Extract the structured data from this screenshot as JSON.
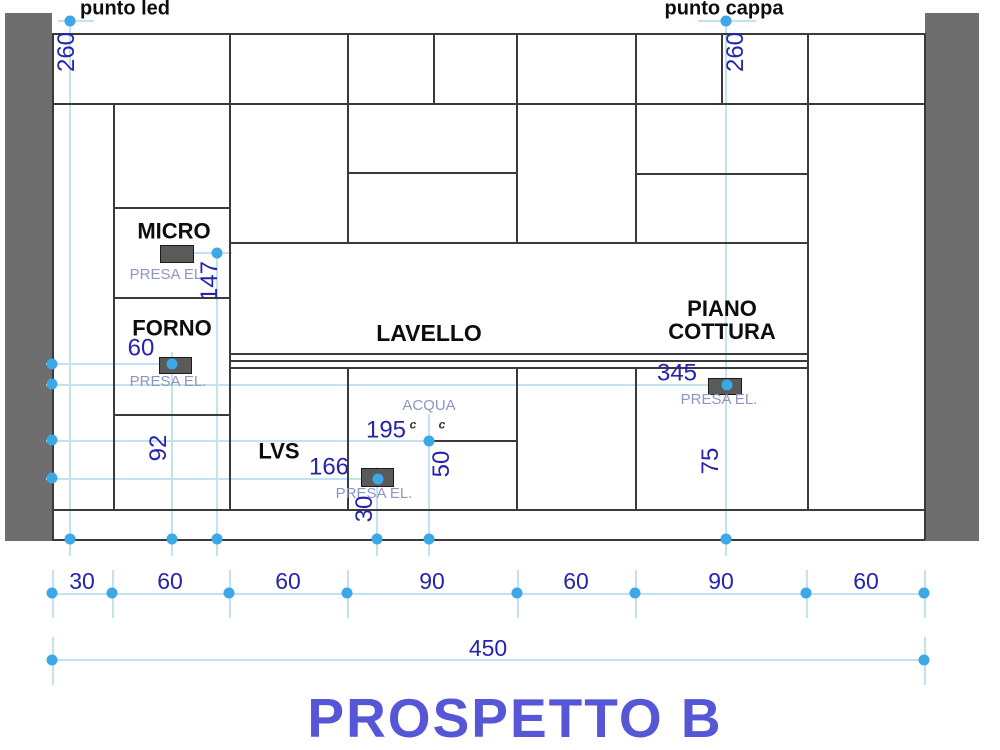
{
  "title": "PROSPETTO B",
  "points": {
    "led": {
      "label": "punto led",
      "height": "260"
    },
    "cappa": {
      "label": "punto cappa",
      "height": "260"
    }
  },
  "cabinets": {
    "micro": "MICRO",
    "forno": "FORNO",
    "lvs": "LVS",
    "lavello": "LAVELLO",
    "piano_cottura": "PIANO COTTURA"
  },
  "outlets": {
    "label": "PRESA EL.",
    "micro_height": "147",
    "forno_height": "92",
    "forno_offset": "60",
    "lvs_offset": "166",
    "lvs_height": "30",
    "cottura_offset": "345",
    "cottura_height": "75"
  },
  "water": {
    "label": "ACQUA",
    "offset": "195",
    "height": "50",
    "symbol": "c"
  },
  "dims": {
    "bottom": [
      "30",
      "60",
      "60",
      "90",
      "60",
      "90",
      "60"
    ],
    "total": "450"
  },
  "colors": {
    "dimension_text": "#2424ad",
    "marker": "#3da8e6",
    "guide_line": "#c2e2ed",
    "wall": "#6e6e6e",
    "outline": "#3a3a3a",
    "presa_text": "#8d96c2",
    "title": "#5656d6"
  }
}
